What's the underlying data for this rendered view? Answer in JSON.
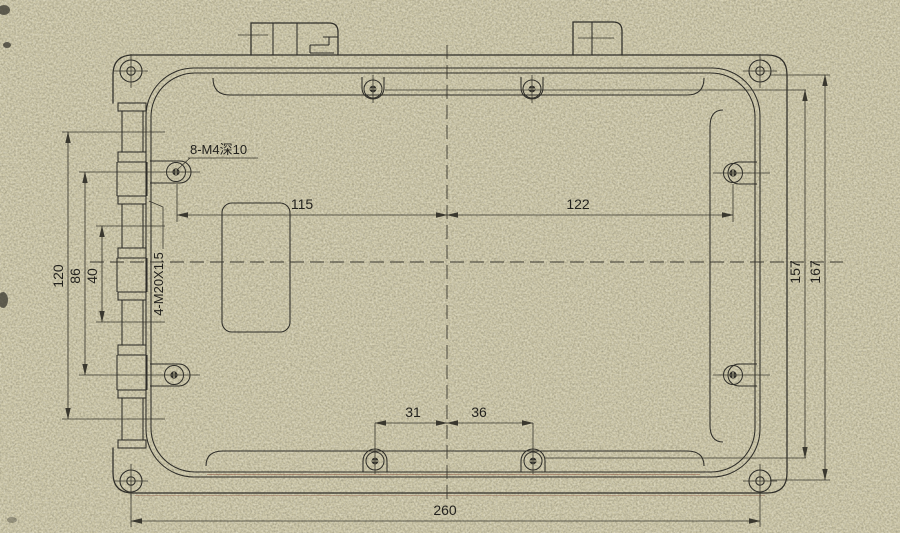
{
  "drawing": {
    "annotations": {
      "m4_note": "8-M4深10",
      "gland_note": "4-M20X1.5"
    },
    "dimensions": {
      "top_left": "115",
      "top_right": "122",
      "left_outer": "120",
      "left_mid": "86",
      "left_inner": "40",
      "right_inner": "157",
      "right_outer": "167",
      "bottom_left": "31",
      "bottom_right": "36",
      "bottom_overall": "260"
    },
    "colors": {
      "paper": "#cfc9a9",
      "line": "#2e2d28",
      "dim_line": "#3a382f",
      "tint_red": "#8a4a33"
    }
  }
}
